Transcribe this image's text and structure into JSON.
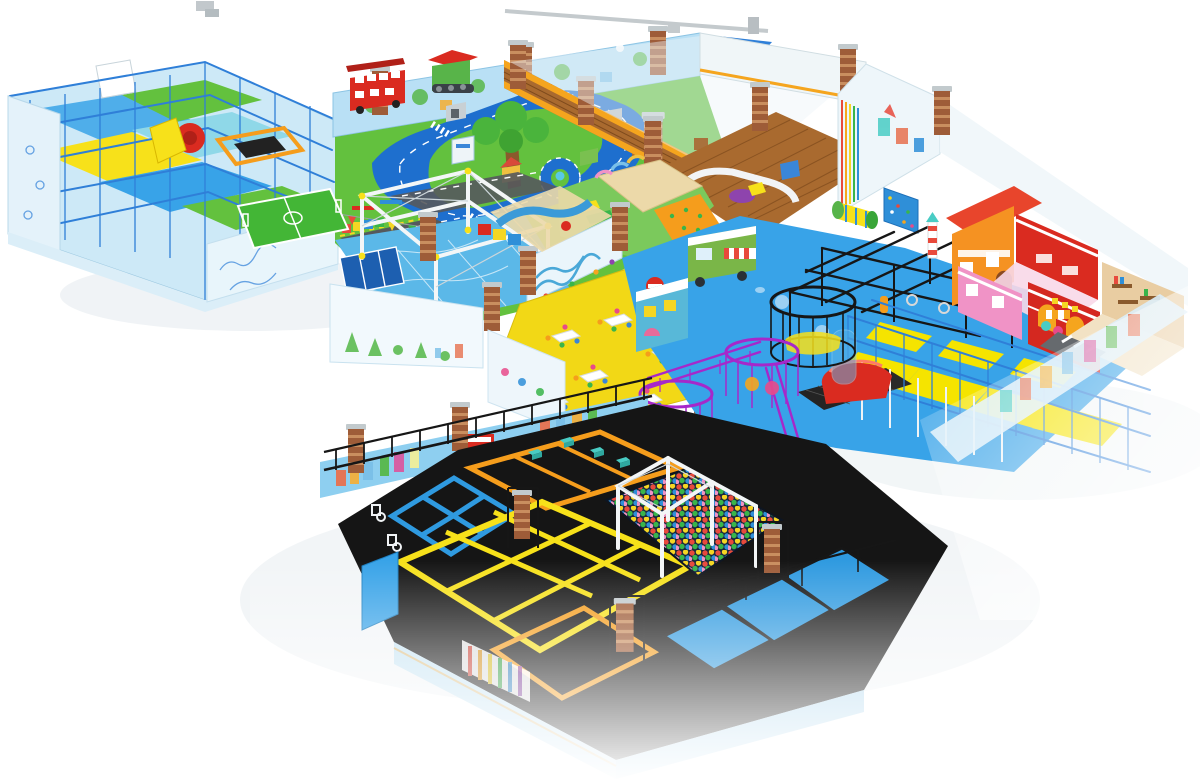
{
  "scene": {
    "description": "3D isometric cutaway render of a large indoor playground / family entertainment center on a white background",
    "style": "perspective architectural visualization, no visible text labels",
    "background": "#ffffff"
  },
  "palette": {
    "floorBlue": "#38a3e8",
    "roadBlue": "#1e6fce",
    "grass": "#63c13e",
    "pitchGreen": "#43b636",
    "sand": "#ecd9a9",
    "wood": "#a96a2f",
    "woodDark": "#7e4a1c",
    "wallLight": "#cde9f7",
    "wallMural": "#b9e0f5",
    "skyWall": "#8ecff0",
    "brick": "#9e5c38",
    "brickLight": "#c98e5f",
    "grayCap": "#c2cacd",
    "frameBlue": "#2f7fd8",
    "truss": "#f3f6f7",
    "yellow": "#f7e11a",
    "deckYellow": "#f5e400",
    "orange": "#f59d1c",
    "trim": "#f5a51e",
    "red": "#da2b20",
    "darkRed": "#b02018",
    "black": "#161616",
    "purple": "#a628ca",
    "magenta": "#cf3ad0",
    "pink": "#f093c6",
    "teal": "#49ccc4",
    "tanRoom": "#e9cda2",
    "ballpitBg": "#19283e",
    "glass": "#eef4f8"
  },
  "zones": [
    {
      "id": "left-softplay",
      "label": "Multi-level soft play maze with blue steel frame, red spiral slide and yellow platforms"
    },
    {
      "id": "traffic-town",
      "label": "Toddler traffic town: blue road loop with roundabout, center tree, red double-decker bus, green tractor, mini buildings"
    },
    {
      "id": "soccer-field",
      "label": "Mini soccer pitch with white markings"
    },
    {
      "id": "ropes-course",
      "label": "White truss ropes course over blue sticker floor with trampoline row"
    },
    {
      "id": "wooden-area",
      "label": "Wooden parquet toddler lounge with white curved bench and soft seats"
    },
    {
      "id": "toddler-zone",
      "label": "Toddler soft zone with sand pit, play arches and orange climbing wedge"
    },
    {
      "id": "party-dining",
      "label": "Party dining area on yellow floor with white tables and colored chairs",
      "tables": 6
    },
    {
      "id": "blue-floor-hub",
      "label": "Central blue floor with food-truck playhouse, train playhouse, climbing roller and rock wall"
    },
    {
      "id": "ninja-course",
      "label": "Black steel ninja rig with hanging obstacles"
    },
    {
      "id": "climb-towers",
      "label": "Purple wire crow's-nest climbing towers, magenta spiral tower and black circular tower"
    },
    {
      "id": "role-play-town",
      "label": "Role-play street: orange house with red roof, red fire station, pink house, sweet shop awning, tan cafe room"
    },
    {
      "id": "right-structure",
      "label": "Two-level blue-frame play structure with yellow decks, black net beds, tube and red dome slide"
    },
    {
      "id": "trampoline-park",
      "label": "Trampoline park on black padding with blue, orange and yellow framed courts, foam blocks, basketball hoops and perimeter railing",
      "courts": [
        "blue",
        "orange",
        "yellow",
        "orange"
      ]
    },
    {
      "id": "ball-pit",
      "label": "Colorful ball pit under a white ninja truss portal"
    },
    {
      "id": "zipline",
      "label": "Ceiling rail with blue hazard-striped zip-line platform"
    }
  ],
  "props": {
    "pillars": "brown brick pillars with grey caps at wall junctions",
    "murals": "city-skyline and forest wall prints, red bus mural on trampoline wall",
    "railing": "black perimeter safety railing",
    "ball_colors": [
      "#e84a3c",
      "#f5d623",
      "#39b54a",
      "#2f8fd8",
      "#f093c6",
      "#8e44ad"
    ]
  }
}
